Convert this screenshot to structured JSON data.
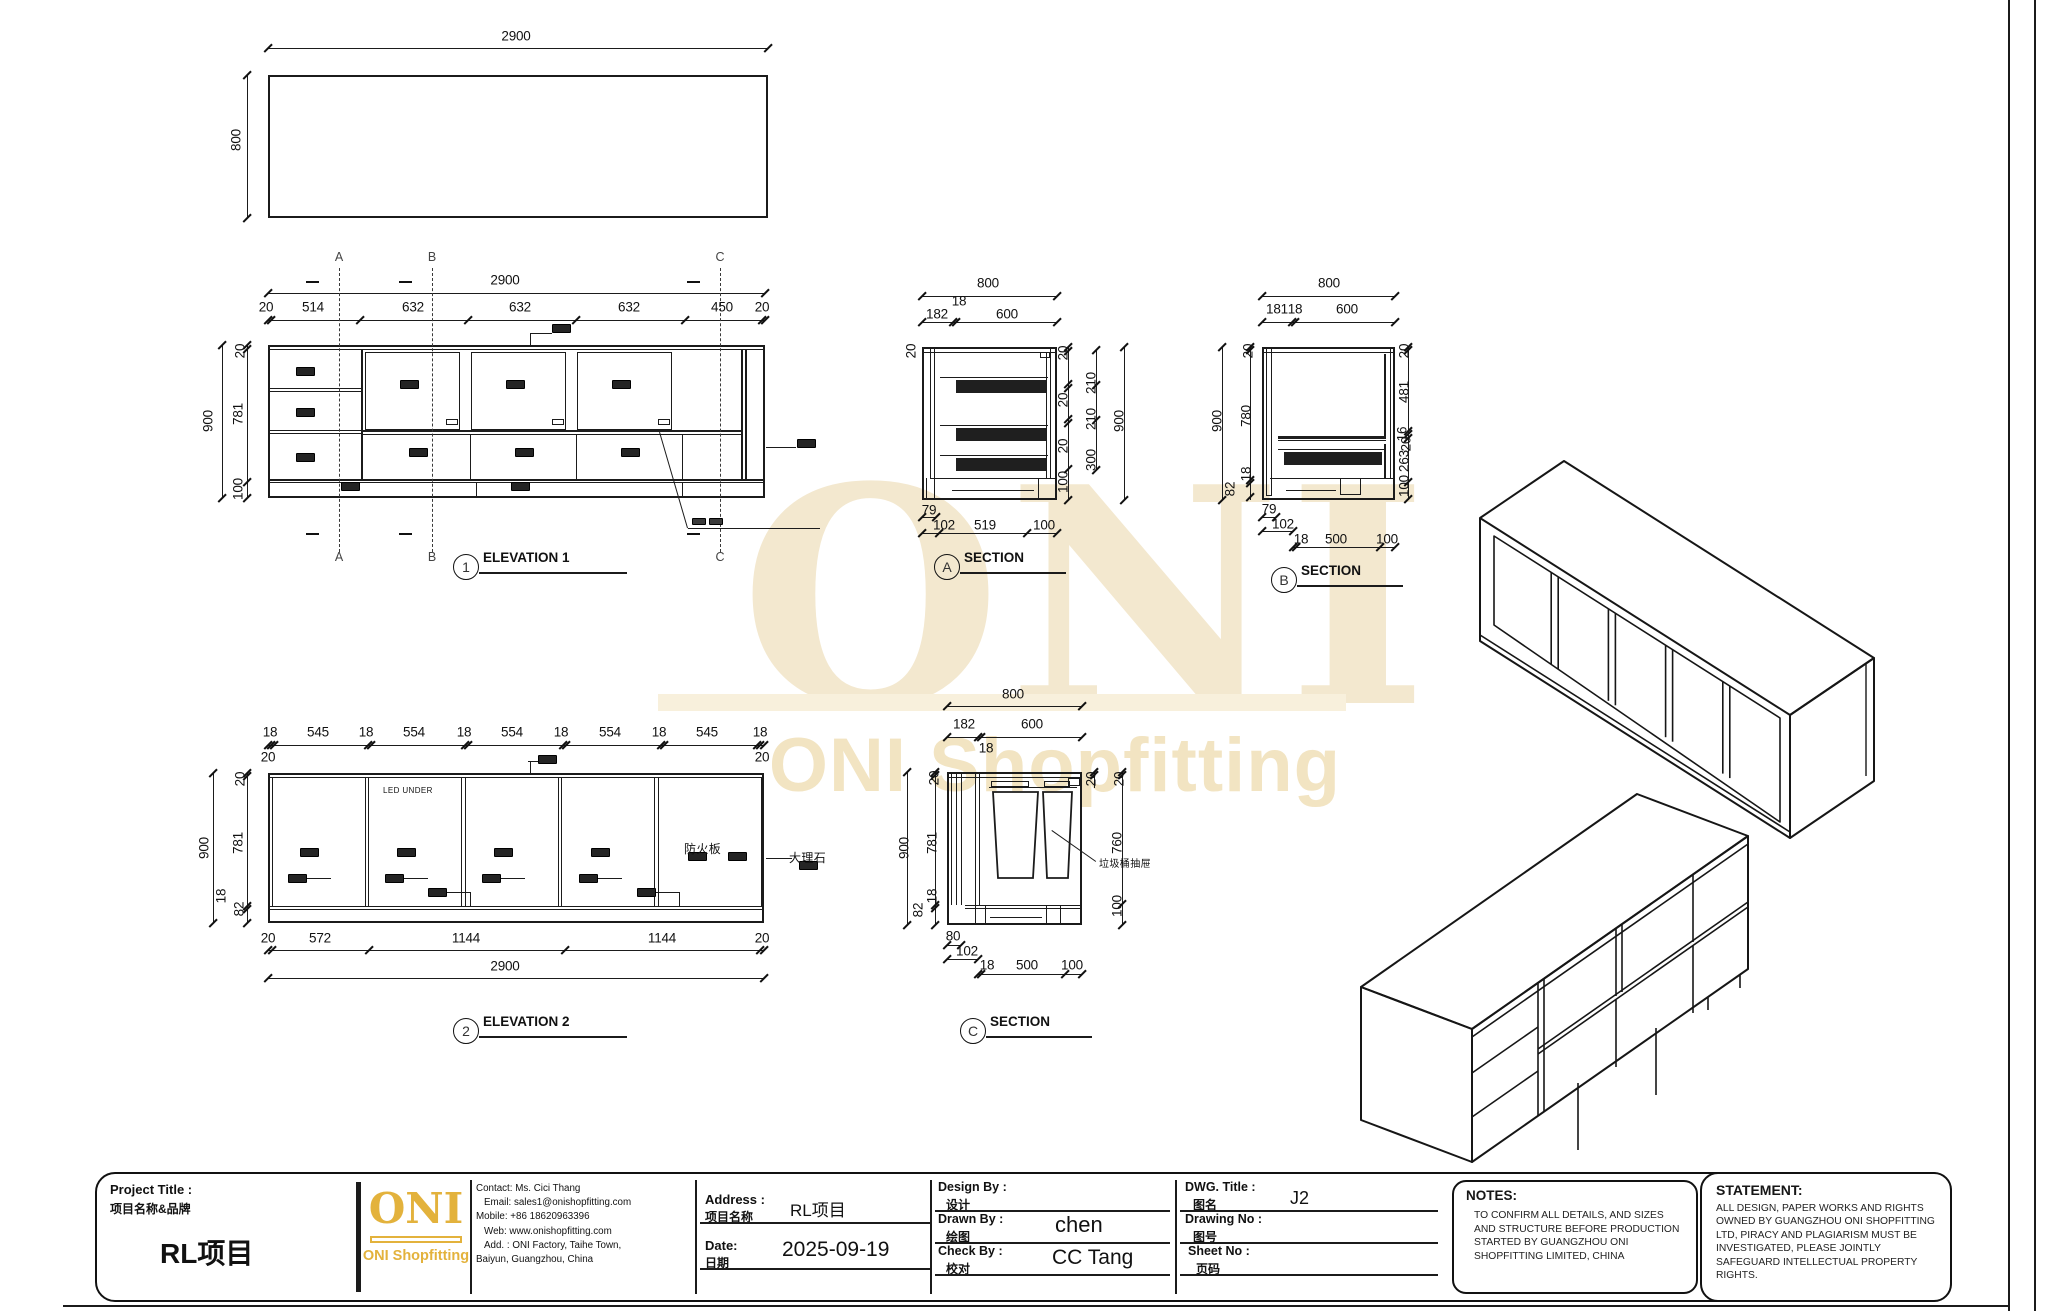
{
  "watermark": {
    "big": "ONI",
    "sub": "ONI Shopfitting"
  },
  "plan_view": {
    "width": "2900",
    "height": "800"
  },
  "drawing": {
    "dim_labels": [
      {
        "t": "2900",
        "x": 516,
        "y": 36
      },
      {
        "t": "800",
        "x": 236,
        "y": 140,
        "v": 1
      },
      {
        "t": "2900",
        "x": 505,
        "y": 280
      },
      {
        "t": "20",
        "x": 266,
        "y": 307
      },
      {
        "t": "514",
        "x": 313,
        "y": 307
      },
      {
        "t": "632",
        "x": 413,
        "y": 307
      },
      {
        "t": "632",
        "x": 520,
        "y": 307
      },
      {
        "t": "632",
        "x": 629,
        "y": 307
      },
      {
        "t": "450",
        "x": 722,
        "y": 307
      },
      {
        "t": "20",
        "x": 762,
        "y": 307
      },
      {
        "t": "900",
        "x": 208,
        "y": 421,
        "v": 1
      },
      {
        "t": "20",
        "x": 240,
        "y": 351,
        "v": 1
      },
      {
        "t": "781",
        "x": 238,
        "y": 414,
        "v": 1
      },
      {
        "t": "100",
        "x": 238,
        "y": 489,
        "v": 1
      },
      {
        "t": "18",
        "x": 270,
        "y": 732
      },
      {
        "t": "545",
        "x": 318,
        "y": 732
      },
      {
        "t": "18",
        "x": 366,
        "y": 732
      },
      {
        "t": "554",
        "x": 414,
        "y": 732
      },
      {
        "t": "18",
        "x": 464,
        "y": 732
      },
      {
        "t": "554",
        "x": 512,
        "y": 732
      },
      {
        "t": "18",
        "x": 561,
        "y": 732
      },
      {
        "t": "554",
        "x": 610,
        "y": 732
      },
      {
        "t": "18",
        "x": 659,
        "y": 732
      },
      {
        "t": "545",
        "x": 707,
        "y": 732
      },
      {
        "t": "18",
        "x": 760,
        "y": 732
      },
      {
        "t": "20",
        "x": 268,
        "y": 757
      },
      {
        "t": "20",
        "x": 762,
        "y": 757
      },
      {
        "t": "900",
        "x": 204,
        "y": 848,
        "v": 1
      },
      {
        "t": "20",
        "x": 240,
        "y": 779,
        "v": 1
      },
      {
        "t": "781",
        "x": 238,
        "y": 843,
        "v": 1
      },
      {
        "t": "18",
        "x": 221,
        "y": 896,
        "v": 1
      },
      {
        "t": "82",
        "x": 239,
        "y": 909,
        "v": 1
      },
      {
        "t": "20",
        "x": 268,
        "y": 938
      },
      {
        "t": "572",
        "x": 320,
        "y": 938
      },
      {
        "t": "1144",
        "x": 466,
        "y": 938
      },
      {
        "t": "1144",
        "x": 662,
        "y": 938
      },
      {
        "t": "20",
        "x": 762,
        "y": 938
      },
      {
        "t": "2900",
        "x": 505,
        "y": 966
      },
      {
        "t": "800",
        "x": 988,
        "y": 283
      },
      {
        "t": "18",
        "x": 959,
        "y": 301
      },
      {
        "t": "182",
        "x": 937,
        "y": 314
      },
      {
        "t": "600",
        "x": 1007,
        "y": 314
      },
      {
        "t": "20",
        "x": 911,
        "y": 351,
        "v": 1
      },
      {
        "t": "20",
        "x": 1063,
        "y": 353,
        "v": 1
      },
      {
        "t": "20",
        "x": 1063,
        "y": 400,
        "v": 1
      },
      {
        "t": "20",
        "x": 1063,
        "y": 446,
        "v": 1
      },
      {
        "t": "100",
        "x": 1063,
        "y": 482,
        "v": 1
      },
      {
        "t": "210",
        "x": 1091,
        "y": 383,
        "v": 1
      },
      {
        "t": "210",
        "x": 1091,
        "y": 419,
        "v": 1
      },
      {
        "t": "300",
        "x": 1091,
        "y": 460,
        "v": 1
      },
      {
        "t": "900",
        "x": 1119,
        "y": 421,
        "v": 1
      },
      {
        "t": "79",
        "x": 929,
        "y": 510
      },
      {
        "t": "102",
        "x": 944,
        "y": 525
      },
      {
        "t": "519",
        "x": 985,
        "y": 525
      },
      {
        "t": "100",
        "x": 1044,
        "y": 525
      },
      {
        "t": "800",
        "x": 1329,
        "y": 283
      },
      {
        "t": "181",
        "x": 1277,
        "y": 309
      },
      {
        "t": "18",
        "x": 1295,
        "y": 309
      },
      {
        "t": "600",
        "x": 1347,
        "y": 309
      },
      {
        "t": "900",
        "x": 1217,
        "y": 421,
        "v": 1
      },
      {
        "t": "20",
        "x": 1248,
        "y": 351,
        "v": 1
      },
      {
        "t": "780",
        "x": 1246,
        "y": 416,
        "v": 1
      },
      {
        "t": "18",
        "x": 1246,
        "y": 474,
        "v": 1
      },
      {
        "t": "82",
        "x": 1230,
        "y": 489,
        "v": 1
      },
      {
        "t": "20",
        "x": 1404,
        "y": 351,
        "v": 1
      },
      {
        "t": "481",
        "x": 1404,
        "y": 392,
        "v": 1
      },
      {
        "t": "16",
        "x": 1402,
        "y": 434,
        "v": 1
      },
      {
        "t": "20",
        "x": 1406,
        "y": 444,
        "v": 1
      },
      {
        "t": "263",
        "x": 1404,
        "y": 461,
        "v": 1
      },
      {
        "t": "100",
        "x": 1404,
        "y": 486,
        "v": 1
      },
      {
        "t": "79",
        "x": 1269,
        "y": 509
      },
      {
        "t": "102",
        "x": 1283,
        "y": 524
      },
      {
        "t": "18",
        "x": 1301,
        "y": 539
      },
      {
        "t": "500",
        "x": 1336,
        "y": 539
      },
      {
        "t": "100",
        "x": 1387,
        "y": 539
      },
      {
        "t": "800",
        "x": 1013,
        "y": 694
      },
      {
        "t": "182",
        "x": 964,
        "y": 724
      },
      {
        "t": "600",
        "x": 1032,
        "y": 724
      },
      {
        "t": "18",
        "x": 986,
        "y": 748
      },
      {
        "t": "900",
        "x": 904,
        "y": 848,
        "v": 1
      },
      {
        "t": "20",
        "x": 934,
        "y": 778,
        "v": 1
      },
      {
        "t": "781",
        "x": 932,
        "y": 843,
        "v": 1
      },
      {
        "t": "18",
        "x": 932,
        "y": 896,
        "v": 1
      },
      {
        "t": "82",
        "x": 918,
        "y": 910,
        "v": 1
      },
      {
        "t": "20",
        "x": 1091,
        "y": 779,
        "v": 1
      },
      {
        "t": "20",
        "x": 1119,
        "y": 779,
        "v": 1
      },
      {
        "t": "760",
        "x": 1117,
        "y": 843,
        "v": 1
      },
      {
        "t": "100",
        "x": 1117,
        "y": 906,
        "v": 1
      },
      {
        "t": "80",
        "x": 953,
        "y": 936
      },
      {
        "t": "102",
        "x": 967,
        "y": 951
      },
      {
        "t": "18",
        "x": 987,
        "y": 965
      },
      {
        "t": "500",
        "x": 1027,
        "y": 965
      },
      {
        "t": "100",
        "x": 1072,
        "y": 965
      }
    ],
    "section_marks": [
      {
        "t": "A",
        "x": 339,
        "y": 257
      },
      {
        "t": "B",
        "x": 432,
        "y": 257
      },
      {
        "t": "C",
        "x": 720,
        "y": 257
      },
      {
        "t": "A",
        "x": 339,
        "y": 557
      },
      {
        "t": "B",
        "x": 432,
        "y": 557
      },
      {
        "t": "C",
        "x": 720,
        "y": 557
      }
    ],
    "callouts": [
      {
        "n": "1",
        "t": "ELEVATION 1",
        "x": 466,
        "y": 567,
        "w": 128
      },
      {
        "n": "2",
        "t": "ELEVATION 2",
        "x": 466,
        "y": 1031,
        "w": 128
      },
      {
        "n": "A",
        "t": "SECTION",
        "x": 947,
        "y": 567,
        "w": 86
      },
      {
        "n": "B",
        "t": "SECTION",
        "x": 1284,
        "y": 580,
        "w": 86
      },
      {
        "n": "C",
        "t": "SECTION",
        "x": 973,
        "y": 1031,
        "w": 86
      }
    ],
    "texts": [
      {
        "t": "LED UNDER",
        "x": 383,
        "y": 786,
        "fs": 8
      },
      {
        "t": "防火板",
        "x": 684,
        "y": 840,
        "fs": 12
      },
      {
        "t": "大理石",
        "x": 789,
        "y": 849,
        "fs": 12
      },
      {
        "t": "垃圾桶抽屉",
        "x": 1099,
        "y": 855,
        "fs": 10
      }
    ]
  },
  "titleblock": {
    "project_label": "Project Title :",
    "project_label_cn": "项目名称&品牌",
    "project_value": "RL项目",
    "logo_text": "ONI",
    "logo_sub": "ONI Shopfitting",
    "contact_lines": [
      "Contact:  Ms. Cici Thang",
      "Email: sales1@onishopfitting.com",
      "Mobile:  +86 18620963396",
      "Web: www.onishopfitting.com",
      "Add. :  ONI Factory, Taihe Town,",
      "Baiyun, Guangzhou, China"
    ],
    "address_label": "Address :",
    "address_label_cn": "项目名称",
    "address_value": "RL项目",
    "date_label": "Date:",
    "date_label_cn": "日期",
    "date_value": "2025-09-19",
    "design_label": "Design By :",
    "design_label_cn": "设计",
    "design_value": "",
    "drawn_label": "Drawn By :",
    "drawn_label_cn": "绘图",
    "drawn_value": "chen",
    "check_label": "Check By :",
    "check_label_cn": "校对",
    "check_value": "CC Tang",
    "dwg_label": "DWG. Title :",
    "dwg_label_cn": "图名",
    "dwg_value": "J2",
    "drawing_no_label": "Drawing No :",
    "drawing_no_label_cn": "图号",
    "drawing_no_value": "",
    "sheet_no_label": "Sheet No :",
    "sheet_no_label_cn": "页码",
    "sheet_no_value": "",
    "notes_heading": "NOTES:",
    "notes_body": "TO CONFIRM ALL DETAILS, AND SIZES AND STRUCTURE BEFORE PRODUCTION STARTED BY GUANGZHOU ONI SHOPFITTING LIMITED, CHINA",
    "statement_heading": "STATEMENT:",
    "statement_body": "ALL DESIGN, PAPER WORKS AND RIGHTS OWNED BY GUANGZHOU ONI SHOPFITTING LTD, PIRACY AND PLAGIARISM MUST BE INVESTIGATED, PLEASE JOINTLY SAFEGUARD INTELLECTUAL PROPERTY RIGHTS."
  },
  "colors": {
    "brand_gold": "#E3B23C",
    "line": "#1b1b1b",
    "watermark": "#f3e8cf"
  }
}
